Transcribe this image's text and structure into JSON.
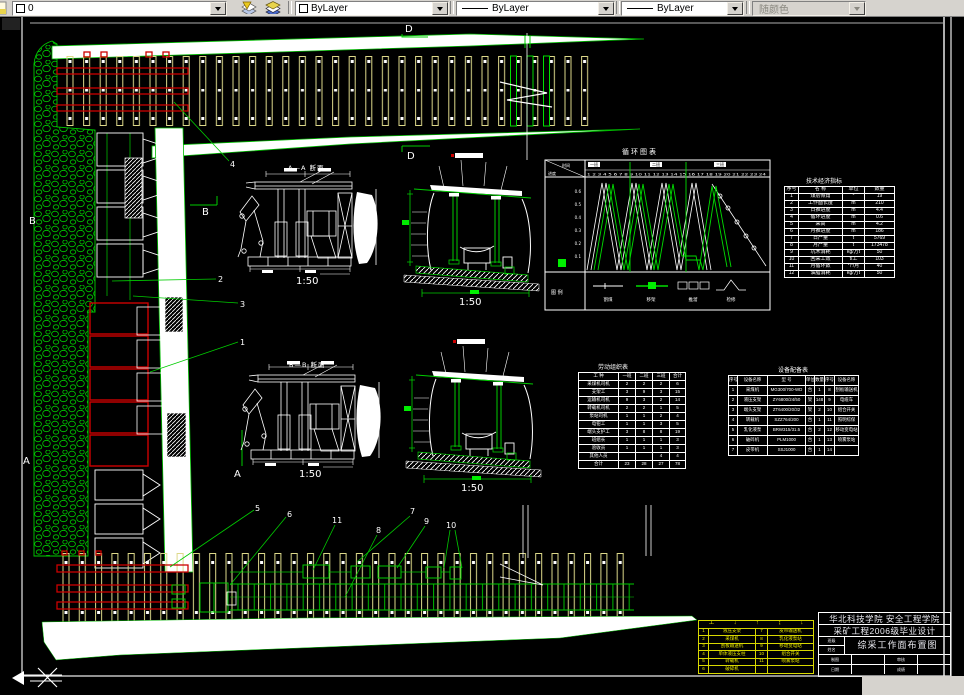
{
  "toolbar": {
    "layer_value": "0",
    "color_value": "ByLayer",
    "linetype_value": "ByLayer",
    "lineweight_value": "ByLayer",
    "plot_style_value": "随颜色"
  },
  "labels": {
    "scale": "1:50",
    "section_aa": "A—A 断面",
    "section_bb": "B—B 断面",
    "d_mark": "D",
    "a_mark": "A",
    "b_mark": "B"
  },
  "callouts": [
    "1",
    "2",
    "3",
    "4",
    "5",
    "6",
    "7",
    "8",
    "9",
    "10",
    "11"
  ],
  "cycle_chart": {
    "title": "循环图表",
    "corner_top": "时间",
    "corner_bottom": "进度",
    "hours": "1 2 3 4 5 6 7 8 9 10 11 12 13 14 15 16 17 18 19 20 21 22 23 24",
    "shifts": [
      "一班",
      "二班",
      "三班"
    ],
    "axis": [
      "0.6",
      "0.5",
      "0.4",
      "0.3",
      "0.2",
      "0.1"
    ],
    "row_label": "图 例",
    "legend": [
      "割煤",
      "移架",
      "推溜",
      "检修"
    ]
  },
  "tech_table": {
    "title": "技术经济指标",
    "headers": [
      "序号",
      "名 称",
      "单位",
      "数量"
    ],
    "rows": [
      {
        "no": "1",
        "name": "煤层倾角",
        "unit": "°",
        "val": "19"
      },
      {
        "no": "2",
        "name": "工作面长度",
        "unit": "m",
        "val": "210"
      },
      {
        "no": "3",
        "name": "日推进度",
        "unit": "m",
        "val": "4.4"
      },
      {
        "no": "4",
        "name": "循环进度",
        "unit": "m",
        "val": "0.6"
      },
      {
        "no": "5",
        "name": "采高",
        "unit": "m",
        "val": "4.2"
      },
      {
        "no": "6",
        "name": "月推进度",
        "unit": "m",
        "val": "186"
      },
      {
        "no": "7",
        "name": "日产量",
        "unit": "t",
        "val": "5769"
      },
      {
        "no": "8",
        "name": "月产量",
        "unit": "t",
        "val": "173478"
      },
      {
        "no": "9",
        "name": "坑木消耗",
        "unit": "kg/万t",
        "val": "50"
      },
      {
        "no": "10",
        "name": "回采工效",
        "unit": "t/工",
        "val": "103"
      },
      {
        "no": "11",
        "name": "月循环数",
        "unit": "个/月",
        "val": "40"
      },
      {
        "no": "12",
        "name": "油脂消耗",
        "unit": "kg/万t",
        "val": "50"
      }
    ]
  },
  "labor_table": {
    "title": "劳动组织表",
    "headers": [
      "工 种",
      "一班",
      "二班",
      "三班",
      "合计"
    ],
    "rows": [
      {
        "name": "采煤机司机",
        "a": "2",
        "b": "2",
        "c": "2",
        "t": "6"
      },
      {
        "name": "支架工",
        "a": "3",
        "b": "9",
        "c": "3",
        "t": "15"
      },
      {
        "name": "运输机司机",
        "a": "9",
        "b": "3",
        "c": "2",
        "t": "14"
      },
      {
        "name": "转载机司机",
        "a": "2",
        "b": "2",
        "c": "1",
        "t": "5"
      },
      {
        "name": "泵站司机",
        "a": "1",
        "b": "1",
        "c": "2",
        "t": "4"
      },
      {
        "name": "电钳工",
        "a": "1",
        "b": "1",
        "c": "3",
        "t": "5"
      },
      {
        "name": "端头支护工",
        "a": "3",
        "b": "8",
        "c": "8",
        "t": "19"
      },
      {
        "name": "班组长",
        "a": "1",
        "b": "1",
        "c": "1",
        "t": "3"
      },
      {
        "name": "验收员",
        "a": "1",
        "b": "1",
        "c": "1",
        "t": "3"
      },
      {
        "name": "其他人员",
        "a": "",
        "b": "",
        "c": "4",
        "t": "4"
      },
      {
        "name": "合计",
        "a": "23",
        "b": "28",
        "c": "27",
        "t": "78"
      }
    ]
  },
  "equipment_table": {
    "title": "设备配备表",
    "headers": [
      "序号",
      "设备名称",
      "型 号",
      "单位",
      "数量",
      "序号",
      "设备名称"
    ],
    "rows": [
      {
        "no": "1",
        "name": "采煤机",
        "model": "MG300/700-WD",
        "unit": "台",
        "qty": "1",
        "no2": "8",
        "name2": "刮板输送机"
      },
      {
        "no": "2",
        "name": "液压支架",
        "model": "ZY6800/24/50",
        "unit": "架",
        "qty": "148",
        "no2": "9",
        "name2": "电缆车"
      },
      {
        "no": "3",
        "name": "端头支架",
        "model": "ZT6400/20/32",
        "unit": "架",
        "qty": "2",
        "no2": "10",
        "name2": "组合开关"
      },
      {
        "no": "4",
        "name": "转载机",
        "model": "SZZ764/200",
        "unit": "台",
        "qty": "1",
        "no2": "11",
        "name2": "照明综保"
      },
      {
        "no": "5",
        "name": "乳化液泵",
        "model": "BRW315/31.5",
        "unit": "台",
        "qty": "2",
        "no2": "12",
        "name2": "移动变电站"
      },
      {
        "no": "6",
        "name": "破碎机",
        "model": "PLM1000",
        "unit": "台",
        "qty": "1",
        "no2": "13",
        "name2": "喷雾泵站"
      },
      {
        "no": "7",
        "name": "皮带机",
        "model": "SSJ1000",
        "unit": "台",
        "qty": "1",
        "no2": "14",
        "name2": ""
      }
    ]
  },
  "legend_table": {
    "symbols": [
      "工",
      "↓",
      "↑",
      "↨",
      "↓"
    ],
    "rows": [
      {
        "no": "1",
        "name": "液压支架",
        "no2": "7",
        "name2": "皮带输送机"
      },
      {
        "no": "2",
        "name": "采煤机",
        "no2": "8",
        "name2": "乳化液泵站"
      },
      {
        "no": "3",
        "name": "刮板输送机",
        "no2": "9",
        "name2": "移动变电站"
      },
      {
        "no": "4",
        "name": "单体液压支柱",
        "no2": "10",
        "name2": "组合开关"
      },
      {
        "no": "5",
        "name": "转载机",
        "no2": "11",
        "name2": "喷雾泵站"
      },
      {
        "no": "6",
        "name": "破碎机",
        "no2": "",
        "name2": ""
      }
    ]
  },
  "title_block": {
    "school": "华北科技学院 安全工程学院",
    "project": "采矿工程2006级毕业设计",
    "drawing_title": "综采工作面布置图",
    "left_cells": [
      "班级",
      "姓名"
    ],
    "row1": [
      "制图",
      "",
      "审核",
      ""
    ],
    "row2": [
      "日期",
      "",
      "成绩",
      ""
    ]
  }
}
